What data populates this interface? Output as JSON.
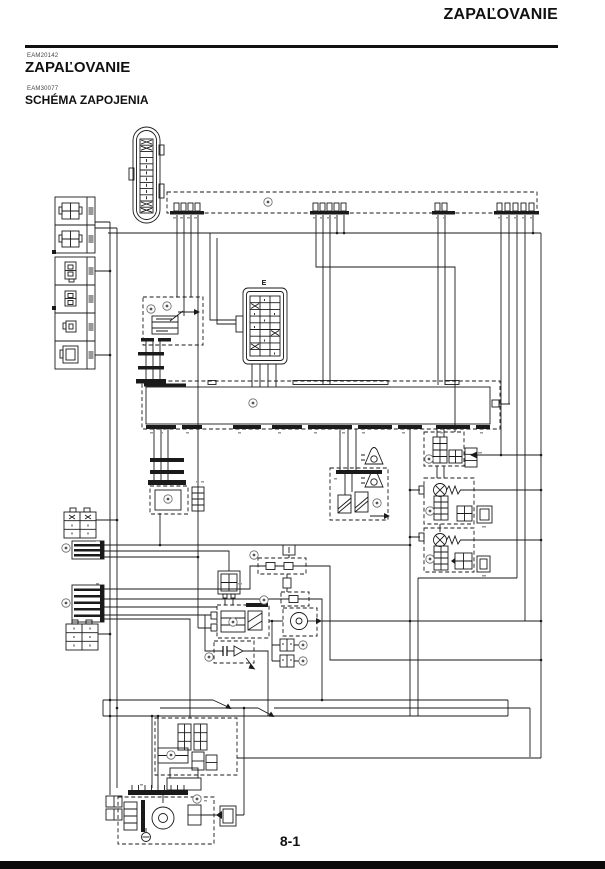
{
  "page": {
    "header_title": "ZAPAĽOVANIE",
    "top_code": "EAM20142",
    "section_title": "ZAPAĽOVANIE",
    "sub_code": "EAM30077",
    "subsection_title": "SCHÉMA ZAPOJENIA",
    "page_number": "8-1"
  },
  "diagram": {
    "connector_e_label": "E"
  }
}
